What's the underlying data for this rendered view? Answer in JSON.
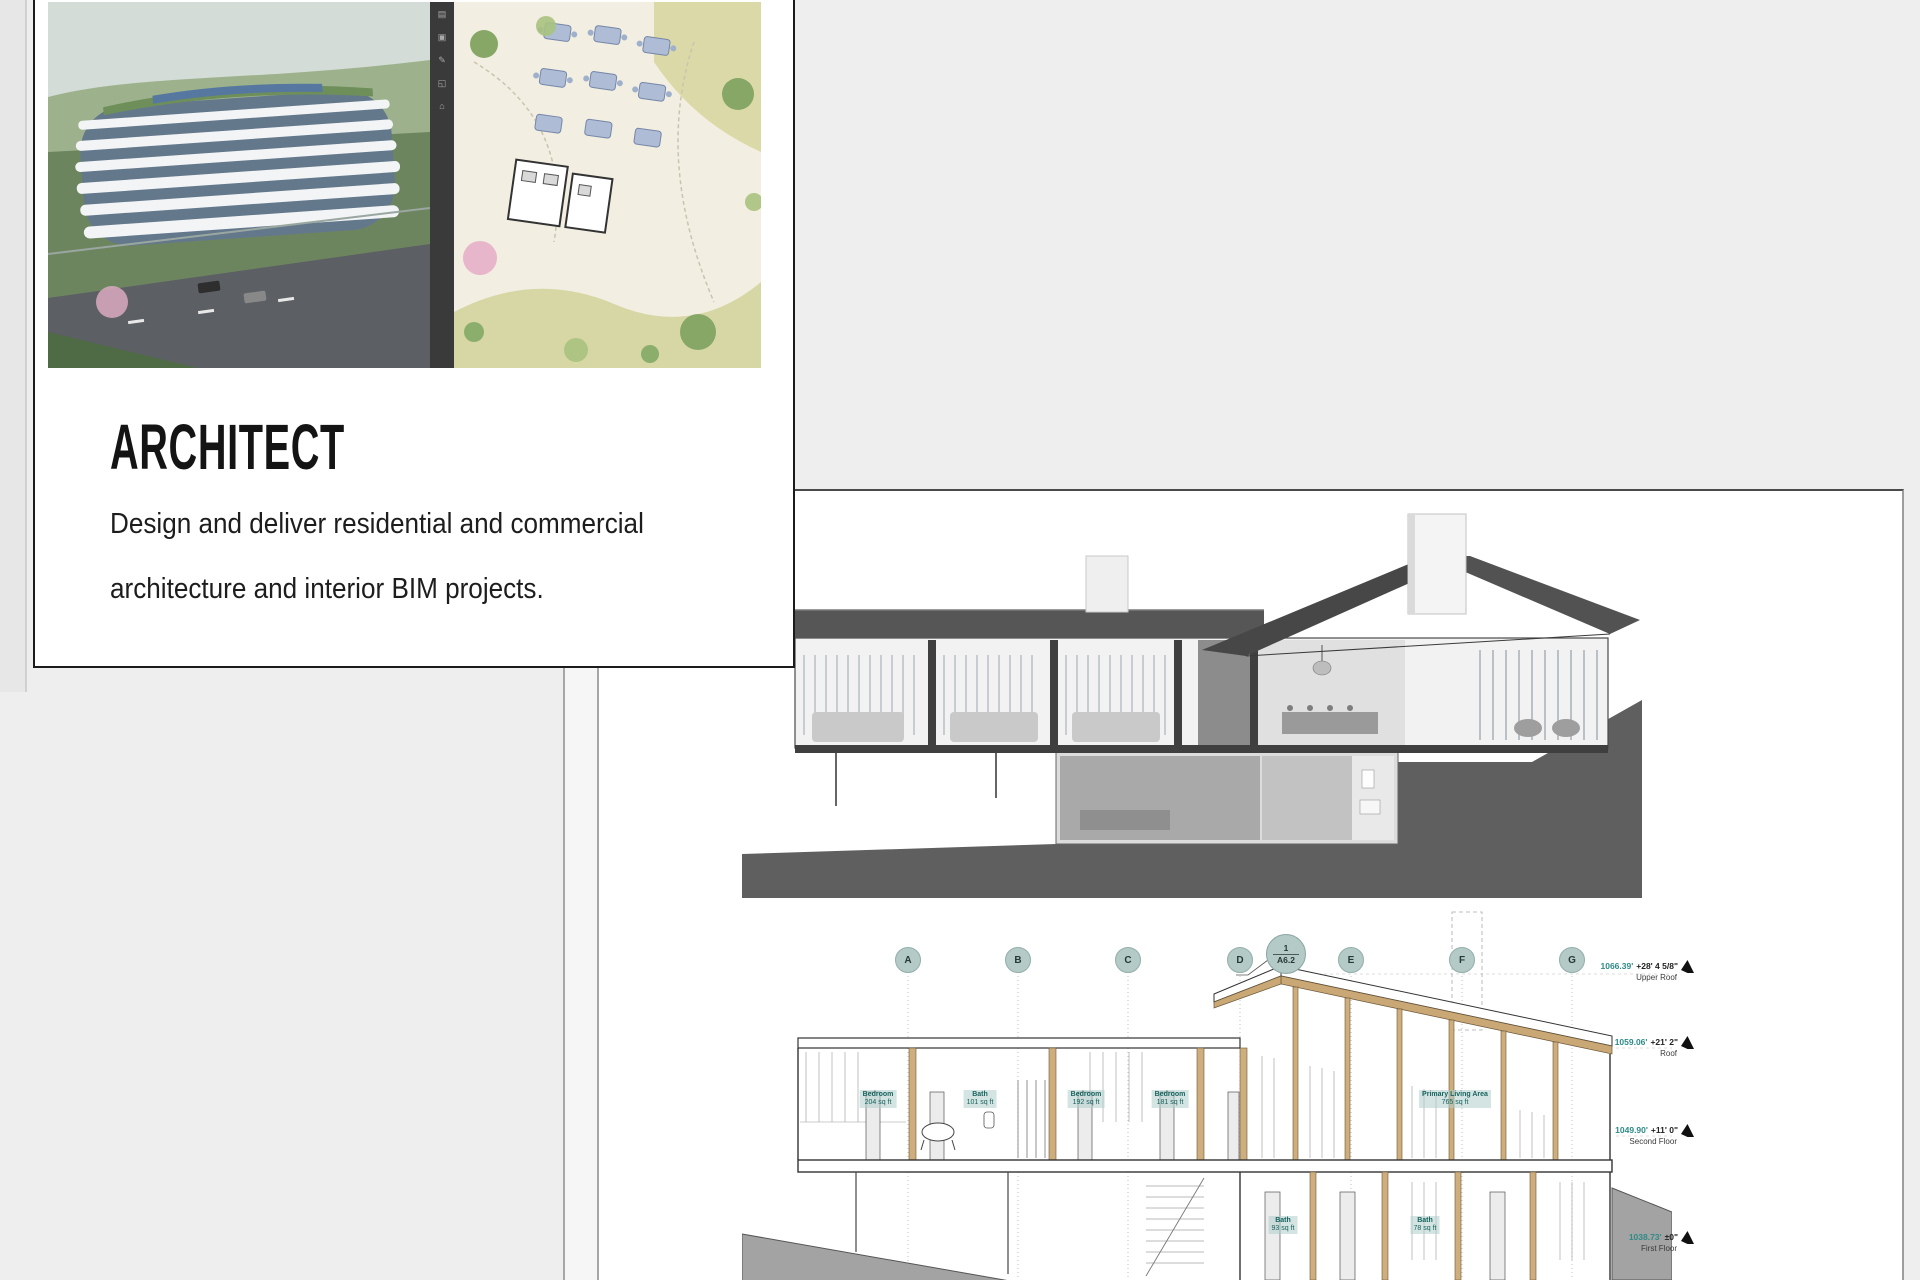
{
  "card": {
    "title": "ARCHITECT",
    "description_line1": "Design and deliver residential and commercial",
    "description_line2": "architecture and interior BIM projects.",
    "toolbar_glyphs": [
      "▤",
      "▣",
      "✎",
      "◱",
      "⌂"
    ]
  },
  "sheet": {
    "view": {
      "number": "2",
      "title": "Longitudinal Section",
      "scale": "Scale: 1/4\" = 1'-0\""
    },
    "grid_bubbles": [
      "A",
      "B",
      "C",
      "D",
      "E",
      "F",
      "G"
    ],
    "section_callout": {
      "detail_number": "1",
      "sheet_number": "A6.2"
    },
    "levels": [
      {
        "elevation": "1066.39'",
        "offset": "+28' 4 5/8\"",
        "name": "Upper Roof"
      },
      {
        "elevation": "1059.06'",
        "offset": "+21' 2\"",
        "name": "Roof"
      },
      {
        "elevation": "1049.90'",
        "offset": "+11' 0\"",
        "name": "Second Floor"
      },
      {
        "elevation": "1038.73'",
        "offset": "±0\"",
        "name": "First Floor"
      }
    ],
    "room_tags": [
      {
        "name": "Bedroom",
        "area": "204 sq ft"
      },
      {
        "name": "Bath",
        "area": "101 sq ft"
      },
      {
        "name": "Bedroom",
        "area": "192 sq ft"
      },
      {
        "name": "Bedroom",
        "area": "181 sq ft"
      },
      {
        "name": "Primary Living Area",
        "area": "765 sq ft"
      },
      {
        "name": "Bath",
        "area": "93 sq ft"
      },
      {
        "name": "Bath",
        "area": "78 sq ft"
      }
    ]
  },
  "titleblock": {
    "logo_letter": "V",
    "project_name": "Dover Dam House",
    "project_address": "38437 John Mosby Hwy, Middleburg, VA 20117",
    "architect_label": "Architect",
    "consultant_label": "Consultant",
    "seal": {
      "line1": "DISTRICT OF COLUMBIA",
      "line2": "No. 0000000",
      "line3": "REGISTERED ARCHITECT"
    },
    "revision_table": {
      "col1": "REV",
      "col2": "DATE",
      "col3": "DESCRIPTION"
    },
    "issue_table": {
      "col1": "NO.",
      "col2": "DATE",
      "col3": "ISSUE NOTE"
    },
    "fields": {
      "project_manager_label": "Project Manager",
      "issue_by_label": "Issue By",
      "date_label": "Date",
      "date_value": "09/16/2022",
      "project_no_label": "Project No.",
      "project_id_label": "Project ID",
      "project_id_value": "202203",
      "sheet_title_label": "Sheet Title"
    }
  },
  "colors": {
    "teal_bubble": "#b3cac7",
    "tag_teal": "#17635e",
    "level_teal": "#2e8b87",
    "wood": "#c9a876",
    "roof_gray": "#565656",
    "hill_gray": "#5f5f5f"
  }
}
